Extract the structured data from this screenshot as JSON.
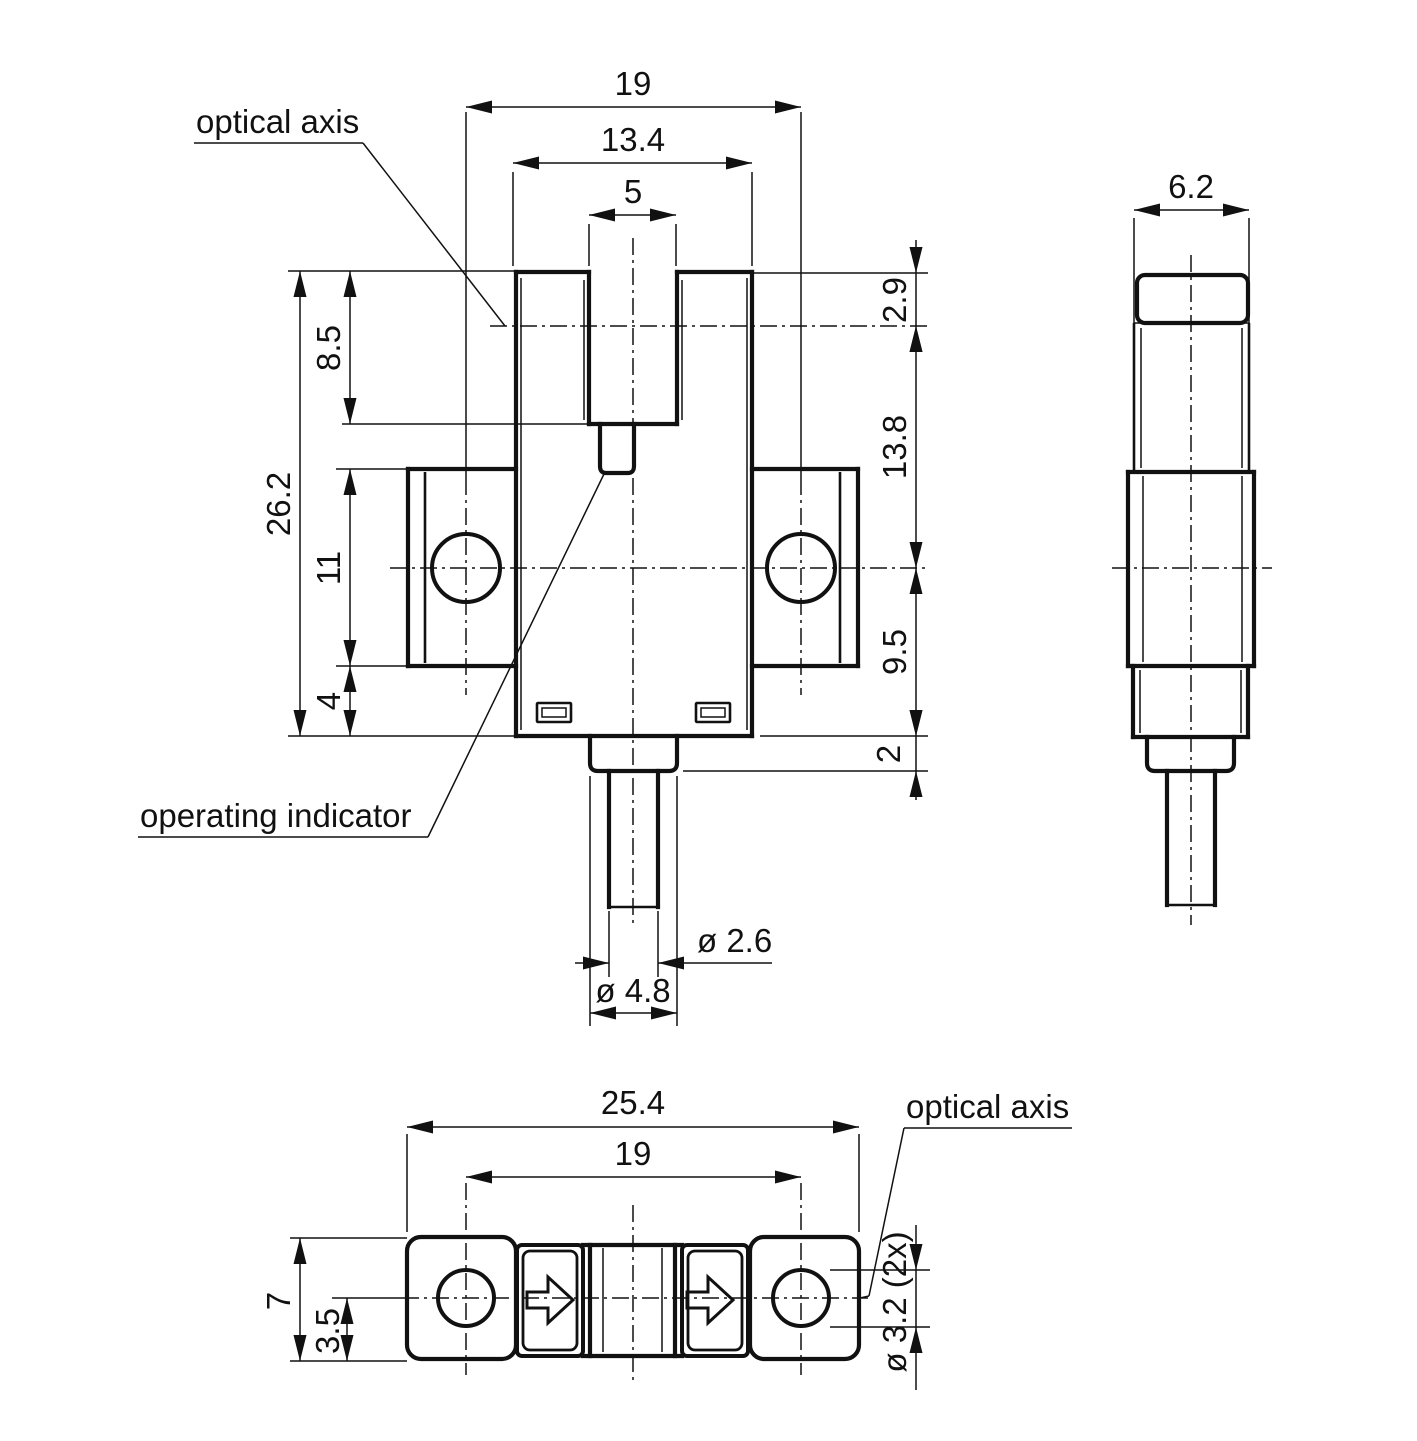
{
  "document": {
    "kind": "technical dimension drawing, fork / slot photoelectric sensor, 3 orthographic views",
    "ink": "#111111",
    "background": "#ffffff"
  },
  "labels": {
    "optical_axis_top": "optical axis",
    "operating_indicator": "operating indicator",
    "optical_axis_bottom": "optical axis"
  },
  "dimensions": {
    "front_view": {
      "hole_spacing": "19",
      "body_width": "13.4",
      "slot_width": "5",
      "slot_depth": "8.5",
      "total_height": "26.2",
      "flange_height": "11",
      "below_flange": "4",
      "top_to_optical_axis": "2.9",
      "optical_axis_to_hole_axis": "13.8",
      "hole_axis_to_bottom": "9.5",
      "collar_step": "2",
      "cable_diameter": "ø 2.6",
      "collar_diameter": "ø 4.8"
    },
    "side_view": {
      "depth": "6.2"
    },
    "bottom_view": {
      "total_length": "25.4",
      "hole_spacing": "19",
      "height": "7",
      "axis_offset": "3.5",
      "mounting_holes": "ø 3.2 (2x)"
    }
  },
  "texts": [
    {
      "n": "dim-fv-hole-spacing",
      "t": "19",
      "x": 633,
      "y": 95,
      "anchor": "middle"
    },
    {
      "n": "dim-fv-body-width",
      "t": "13.4",
      "x": 633,
      "y": 151,
      "anchor": "middle"
    },
    {
      "n": "dim-fv-slot-width",
      "t": "5",
      "x": 633,
      "y": 203,
      "anchor": "middle"
    },
    {
      "n": "label-optical-axis-top",
      "t": "optical axis",
      "x": 196,
      "y": 133,
      "anchor": "start"
    },
    {
      "n": "label-operating-indicator",
      "t": "operating indicator",
      "x": 140,
      "y": 827,
      "anchor": "start"
    },
    {
      "n": "dim-fv-total-height",
      "t": "26.2",
      "x": 290,
      "y": 504,
      "rot": -90,
      "anchor": "middle"
    },
    {
      "n": "dim-fv-slot-depth",
      "t": "8.5",
      "x": 340,
      "y": 348,
      "rot": -90,
      "anchor": "middle"
    },
    {
      "n": "dim-fv-flange-height",
      "t": "11",
      "x": 340,
      "y": 568,
      "rot": -90,
      "anchor": "middle"
    },
    {
      "n": "dim-fv-below-flange",
      "t": "4",
      "x": 340,
      "y": 701,
      "rot": -90,
      "anchor": "middle"
    },
    {
      "n": "dim-fv-top-to-axis",
      "t": "2.9",
      "x": 906,
      "y": 300,
      "rot": -90,
      "anchor": "middle"
    },
    {
      "n": "dim-fv-axis-to-hole",
      "t": "13.8",
      "x": 906,
      "y": 447,
      "rot": -90,
      "anchor": "middle"
    },
    {
      "n": "dim-fv-hole-to-bottom",
      "t": "9.5",
      "x": 906,
      "y": 652,
      "rot": -90,
      "anchor": "middle"
    },
    {
      "n": "dim-fv-collar-step",
      "t": "2",
      "x": 900,
      "y": 754,
      "rot": -90,
      "anchor": "middle"
    },
    {
      "n": "dim-fv-cable-dia",
      "t": "ø 2.6",
      "x": 697,
      "y": 952,
      "anchor": "start"
    },
    {
      "n": "dim-fv-collar-dia",
      "t": "ø 4.8",
      "x": 633,
      "y": 1002,
      "anchor": "middle"
    },
    {
      "n": "dim-sv-depth",
      "t": "6.2",
      "x": 1191,
      "y": 198,
      "anchor": "middle"
    },
    {
      "n": "dim-bv-total-length",
      "t": "25.4",
      "x": 633,
      "y": 1114,
      "anchor": "middle"
    },
    {
      "n": "dim-bv-hole-spacing",
      "t": "19",
      "x": 633,
      "y": 1165,
      "anchor": "middle"
    },
    {
      "n": "dim-bv-height",
      "t": "7",
      "x": 290,
      "y": 1301,
      "rot": -90,
      "anchor": "middle"
    },
    {
      "n": "dim-bv-axis-offset",
      "t": "3.5",
      "x": 339,
      "y": 1331,
      "rot": -90,
      "anchor": "middle"
    },
    {
      "n": "dim-bv-hole-dia",
      "t": "ø 3.2 (2x)",
      "x": 906,
      "y": 1302,
      "rot": -90,
      "anchor": "middle"
    },
    {
      "n": "label-optical-axis-bottom",
      "t": "optical axis",
      "x": 906,
      "y": 1118,
      "anchor": "start"
    }
  ],
  "geometry": {
    "thin": [
      [
        466,
        107,
        801,
        107
      ],
      [
        513,
        163,
        752,
        163
      ],
      [
        589,
        215,
        676,
        215
      ],
      [
        513,
        172,
        513,
        266
      ],
      [
        752,
        172,
        752,
        266
      ],
      [
        589,
        224,
        589,
        266
      ],
      [
        676,
        224,
        676,
        266
      ],
      [
        466,
        112,
        466,
        478
      ],
      [
        801,
        112,
        801,
        478
      ],
      [
        288,
        271,
        516,
        271
      ],
      [
        342,
        424,
        589,
        424
      ],
      [
        288,
        736,
        516,
        736
      ],
      [
        336,
        469,
        408,
        469
      ],
      [
        336,
        666,
        408,
        666
      ],
      [
        300,
        271,
        300,
        736
      ],
      [
        350,
        271,
        350,
        424
      ],
      [
        350,
        469,
        350,
        736
      ],
      [
        752,
        273,
        928,
        273
      ],
      [
        916,
        240,
        916,
        800
      ],
      [
        760,
        736,
        928,
        736
      ],
      [
        683,
        771,
        928,
        771
      ],
      [
        609,
        911,
        609,
        977
      ],
      [
        658,
        911,
        658,
        977
      ],
      [
        575,
        963,
        609,
        963
      ],
      [
        658,
        963,
        772,
        963
      ],
      [
        590,
        776,
        590,
        1026
      ],
      [
        677,
        776,
        677,
        1026
      ],
      [
        590,
        1013,
        677,
        1013
      ],
      [
        194,
        143,
        363,
        143
      ],
      [
        363,
        143,
        505,
        326
      ],
      [
        138,
        837,
        428,
        837
      ],
      [
        428,
        837,
        604,
        474
      ],
      [
        1134,
        218,
        1134,
        323
      ],
      [
        1249,
        218,
        1249,
        323
      ],
      [
        1134,
        210,
        1249,
        210
      ],
      [
        1134,
        323,
        1249,
        323
      ],
      [
        521,
        278,
        521,
        730
      ],
      [
        747,
        278,
        747,
        730
      ],
      [
        584,
        280,
        584,
        420
      ],
      [
        682,
        280,
        682,
        420
      ],
      [
        1141,
        328,
        1141,
        468
      ],
      [
        1242,
        328,
        1242,
        468
      ],
      [
        1143,
        476,
        1143,
        662
      ],
      [
        1242,
        476,
        1242,
        662
      ],
      [
        1140,
        670,
        1140,
        733
      ],
      [
        1241,
        670,
        1241,
        733
      ],
      [
        407,
        1127,
        859,
        1127
      ],
      [
        466,
        1177,
        801,
        1177
      ],
      [
        407,
        1134,
        407,
        1232
      ],
      [
        859,
        1134,
        859,
        1232
      ],
      [
        290,
        1238,
        407,
        1238
      ],
      [
        290,
        1361,
        407,
        1361
      ],
      [
        300,
        1238,
        300,
        1361
      ],
      [
        347,
        1298,
        347,
        1361
      ],
      [
        332,
        1298,
        402,
        1298
      ],
      [
        830,
        1270,
        930,
        1270
      ],
      [
        830,
        1327,
        930,
        1327
      ],
      [
        916,
        1225,
        916,
        1390
      ],
      [
        904,
        1128,
        1072,
        1128
      ],
      [
        904,
        1128,
        869,
        1296
      ],
      [
        869,
        1296,
        860,
        1298
      ],
      [
        603,
        1248,
        603,
        1352
      ],
      [
        662,
        1248,
        662,
        1352
      ]
    ],
    "med": [
      [
        425,
        472,
        425,
        663
      ],
      [
        840,
        472,
        840,
        663
      ],
      [
        1134,
        323,
        1134,
        472
      ],
      [
        1249,
        323,
        1249,
        472
      ],
      [
        609,
        907,
        658,
        907
      ],
      [
        1167,
        905,
        1215,
        905
      ]
    ],
    "thick": [
      [
        516,
        272,
        589,
        272
      ],
      [
        677,
        272,
        752,
        272
      ],
      [
        589,
        272,
        589,
        424
      ],
      [
        677,
        272,
        677,
        424
      ],
      [
        589,
        424,
        677,
        424
      ],
      [
        516,
        272,
        516,
        736
      ],
      [
        752,
        272,
        752,
        736
      ],
      [
        516,
        736,
        752,
        736
      ],
      [
        408,
        469,
        516,
        469
      ],
      [
        408,
        469,
        408,
        666
      ],
      [
        408,
        666,
        516,
        666
      ],
      [
        752,
        469,
        858,
        469
      ],
      [
        858,
        469,
        858,
        666
      ],
      [
        752,
        666,
        858,
        666
      ],
      [
        609,
        771,
        609,
        907
      ],
      [
        658,
        771,
        658,
        907
      ],
      [
        1128,
        472,
        1254,
        472
      ],
      [
        1128,
        472,
        1128,
        666
      ],
      [
        1254,
        472,
        1254,
        666
      ],
      [
        1128,
        666,
        1254,
        666
      ],
      [
        1133,
        666,
        1133,
        737
      ],
      [
        1248,
        666,
        1248,
        737
      ],
      [
        1133,
        737,
        1248,
        737
      ],
      [
        1167,
        771,
        1167,
        905
      ],
      [
        1215,
        771,
        1215,
        905
      ],
      [
        583,
        1245,
        682,
        1245
      ],
      [
        583,
        1356,
        682,
        1356
      ],
      [
        590,
        1245,
        590,
        1356
      ],
      [
        675,
        1245,
        675,
        1356
      ]
    ],
    "axis": [
      [
        633,
        238,
        633,
        925
      ],
      [
        490,
        326,
        928,
        326
      ],
      [
        390,
        568,
        928,
        568
      ],
      [
        466,
        478,
        466,
        695
      ],
      [
        801,
        478,
        801,
        695
      ],
      [
        1191,
        255,
        1191,
        925
      ],
      [
        1112,
        568,
        1272,
        568
      ],
      [
        633,
        1205,
        633,
        1385
      ],
      [
        402,
        1298,
        868,
        1298
      ],
      [
        466,
        1183,
        466,
        1375
      ],
      [
        801,
        1183,
        801,
        1375
      ]
    ],
    "paths": [
      {
        "d": "M600,424 L600,466 Q600,473 606,473 L628,473 Q634,473 634,466 L634,424",
        "sw": 4.2,
        "n": "emitter-tab-outline"
      },
      {
        "d": "M590,736 L590,763 Q590,771 598,771 L669,771 Q677,771 677,763 L677,736",
        "sw": 4.2,
        "n": "cable-collar-outline"
      },
      {
        "d": "M1147,737 L1147,763 Q1147,771 1155,771 L1226,771 Q1234,771 1234,763 L1234,737",
        "sw": 4.2,
        "n": "cable-collar-outline-side"
      }
    ],
    "rrects": [
      {
        "x": 1137,
        "y": 275,
        "w": 111,
        "h": 48,
        "r": 8,
        "sw": 4.2,
        "n": "side-view-cap"
      },
      {
        "x": 407,
        "y": 1237,
        "w": 109,
        "h": 122,
        "r": 14,
        "sw": 4.2,
        "n": "bottom-view-left-lug"
      },
      {
        "x": 750,
        "y": 1237,
        "w": 109,
        "h": 122,
        "r": 14,
        "sw": 4.2,
        "n": "bottom-view-right-lug"
      },
      {
        "x": 517,
        "y": 1245,
        "w": 66,
        "h": 111,
        "r": 5,
        "sw": 4,
        "n": "emitter-window-outer"
      },
      {
        "x": 523,
        "y": 1251,
        "w": 54,
        "h": 99,
        "r": 7,
        "sw": 2.8,
        "n": "emitter-window-inner"
      },
      {
        "x": 682,
        "y": 1245,
        "w": 66,
        "h": 111,
        "r": 5,
        "sw": 4,
        "n": "receiver-window-outer"
      },
      {
        "x": 688,
        "y": 1251,
        "w": 54,
        "h": 99,
        "r": 7,
        "sw": 2.8,
        "n": "receiver-window-inner"
      },
      {
        "x": 537,
        "y": 703,
        "w": 34,
        "h": 19,
        "r": 1,
        "sw": 2.6,
        "n": "operating-indicator-left-outer"
      },
      {
        "x": 542,
        "y": 708,
        "w": 24,
        "h": 9,
        "r": 0,
        "sw": 1.5,
        "n": "operating-indicator-left-inner"
      },
      {
        "x": 696,
        "y": 703,
        "w": 34,
        "h": 19,
        "r": 1,
        "sw": 2.6,
        "n": "operating-indicator-right-outer"
      },
      {
        "x": 701,
        "y": 708,
        "w": 24,
        "h": 9,
        "r": 0,
        "sw": 1.5,
        "n": "operating-indicator-right-inner"
      }
    ],
    "circles": [
      {
        "cx": 466,
        "cy": 568,
        "r": 34,
        "sw": 4,
        "n": "mounting-hole-left"
      },
      {
        "cx": 801,
        "cy": 568,
        "r": 34,
        "sw": 4,
        "n": "mounting-hole-right"
      },
      {
        "cx": 466,
        "cy": 1298,
        "r": 28,
        "sw": 4,
        "n": "mounting-hole-left-bottom-view"
      },
      {
        "cx": 801,
        "cy": 1298,
        "r": 28,
        "sw": 4,
        "n": "mounting-hole-right-bottom-view"
      }
    ],
    "polygons": [
      {
        "pts": "527,1292 548,1292 548,1277 573,1300 548,1323 548,1308 527,1308",
        "sw": 3,
        "n": "light-direction-arrow-left"
      },
      {
        "pts": "687,1292 708,1292 708,1277 733,1300 708,1323 708,1308 687,1308",
        "sw": 3,
        "n": "light-direction-arrow-right"
      }
    ],
    "arrows": [
      {
        "x": 466,
        "y": 107,
        "a": 180
      },
      {
        "x": 801,
        "y": 107,
        "a": 0
      },
      {
        "x": 513,
        "y": 163,
        "a": 180
      },
      {
        "x": 752,
        "y": 163,
        "a": 0
      },
      {
        "x": 589,
        "y": 215,
        "a": 180
      },
      {
        "x": 676,
        "y": 215,
        "a": 0
      },
      {
        "x": 300,
        "y": 271,
        "a": 270
      },
      {
        "x": 300,
        "y": 736,
        "a": 90
      },
      {
        "x": 350,
        "y": 271,
        "a": 270
      },
      {
        "x": 350,
        "y": 424,
        "a": 90
      },
      {
        "x": 350,
        "y": 469,
        "a": 270
      },
      {
        "x": 350,
        "y": 666,
        "a": 90
      },
      {
        "x": 350,
        "y": 666,
        "a": 270
      },
      {
        "x": 350,
        "y": 736,
        "a": 90
      },
      {
        "x": 916,
        "y": 273,
        "a": 90
      },
      {
        "x": 916,
        "y": 326,
        "a": 270
      },
      {
        "x": 916,
        "y": 326,
        "a": 270
      },
      {
        "x": 916,
        "y": 568,
        "a": 90
      },
      {
        "x": 916,
        "y": 568,
        "a": 270
      },
      {
        "x": 916,
        "y": 736,
        "a": 90
      },
      {
        "x": 916,
        "y": 736,
        "a": 90
      },
      {
        "x": 916,
        "y": 771,
        "a": 270
      },
      {
        "x": 609,
        "y": 963,
        "a": 0
      },
      {
        "x": 658,
        "y": 963,
        "a": 180
      },
      {
        "x": 590,
        "y": 1013,
        "a": 180
      },
      {
        "x": 677,
        "y": 1013,
        "a": 0
      },
      {
        "x": 1134,
        "y": 210,
        "a": 180
      },
      {
        "x": 1249,
        "y": 210,
        "a": 0
      },
      {
        "x": 407,
        "y": 1127,
        "a": 180
      },
      {
        "x": 859,
        "y": 1127,
        "a": 0
      },
      {
        "x": 466,
        "y": 1177,
        "a": 180
      },
      {
        "x": 801,
        "y": 1177,
        "a": 0
      },
      {
        "x": 300,
        "y": 1238,
        "a": 270
      },
      {
        "x": 300,
        "y": 1361,
        "a": 90
      },
      {
        "x": 347,
        "y": 1298,
        "a": 270
      },
      {
        "x": 347,
        "y": 1361,
        "a": 90
      },
      {
        "x": 916,
        "y": 1270,
        "a": 90
      },
      {
        "x": 916,
        "y": 1327,
        "a": 270
      }
    ]
  }
}
